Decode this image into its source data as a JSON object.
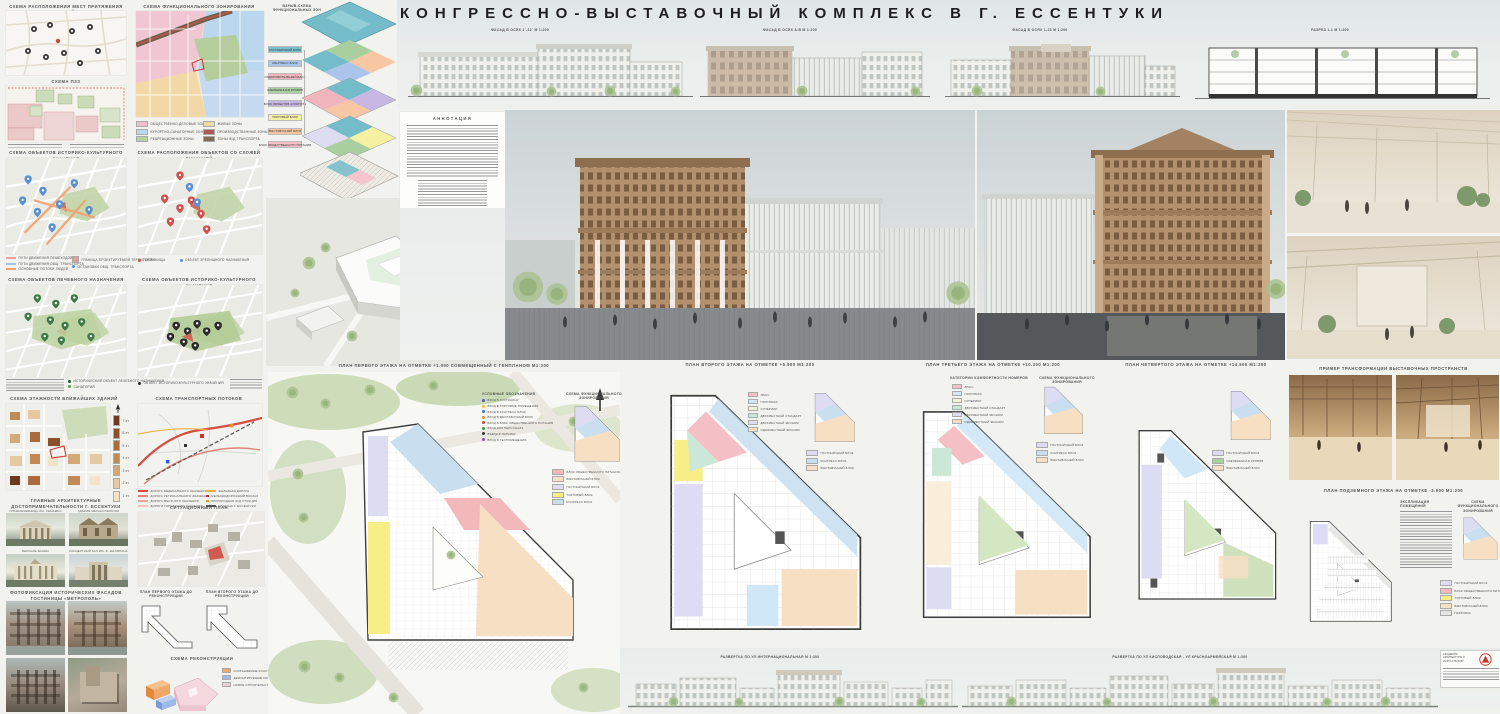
{
  "title": "КОНГРЕССНО-ВЫСТАВОЧНЫЙ КОМПЛЕКС В Г. ЕССЕНТУКИ",
  "top": {
    "facade_a": "ФАСАД В ОСЯХ 1`-22`  М 1:200",
    "facade_b": "ФАСАД В ОСЯХ А-В  М 1:200",
    "facade_c": "ФАСАД В ОСЯХ 1-23  М 1:200",
    "section_label": "РАЗРЕЗ 1-1  М 1:200"
  },
  "annotation": {
    "title": "АННОТАЦИЯ"
  },
  "maps": {
    "attraction_title": "СХЕМА РАСПОЛОЖЕНИЯ МЕСТ ПРИТЯЖЕНИЯ ЛЮДЕЙ",
    "pzz_title": "СХЕМА ПЗЗ",
    "func_title": "СХЕМА ФУНКЦИОНАЛЬНОГО ЗОНИРОВАНИЯ",
    "func_legend": [
      {
        "label": "ОБЩЕСТВЕННО-ДЕЛОВЫЕ ЗОНЫ",
        "color": "#efc0cb"
      },
      {
        "label": "КУРОРТНО-САНАТОРНЫЕ ЗОНЫ",
        "color": "#bad7ee"
      },
      {
        "label": "РЕКРЕАЦИОННЫЕ ЗОНЫ",
        "color": "#bccfa2"
      },
      {
        "label": "ЖИЛЫЕ ЗОНЫ",
        "color": "#f2d8a6"
      },
      {
        "label": "ПРОИЗВОДСТВЕННЫЕ ЗОНЫ",
        "color": "#a95b52"
      },
      {
        "label": "ЗОНЫ Ж/Д ТРАНСПОРТА",
        "color": "#7d6c57"
      }
    ],
    "history1_title": "СХЕМА ОБЪЕКТОВ ИСТОРИКО-КУЛЬТУРНОГО ЗНАЧЕНИЯ",
    "history1_legend": [
      "ПУТИ ДВИЖЕНИЯ ПЕШЕХОДОВ",
      "ПУТИ ДВИЖЕНИЯ ОБЩ. ТРАНСПОРТА",
      "ОСНОВНЫЕ ПОТОКИ ЛЮДЕЙ",
      "ГРАНИЦА ПРОЕКТИРУЕМОЙ ТЕРРИТОРИИ",
      "ОСТАНОВКИ ОБЩ. ТРАНСПОРТА"
    ],
    "similar_title": "СХЕМА РАСПОЛОЖЕНИЯ ОБЪЕКТОВ СО СХОЖЕЙ ФУНКЦИЕЙ",
    "similar_legend": [
      "ГОСТИНИЦЫ",
      "ОБЪЕКТ ЗРЕЛИЩНОГО НАЗНАЧЕНИЯ"
    ],
    "medical_title": "СХЕМА ОБЪЕКТОВ ЛЕЧЕБНОГО НАЗНАЧЕНИЯ",
    "medical_legend": [
      "ИСТОРИЧЕСКИЙ ОБЪЕКТ ЛЕЧЕБНОГО НАЗНАЧЕНИЯ",
      "САНАТОРИЙ"
    ],
    "history2_title": "СХЕМА ОБЪЕКТОВ ИСТОРИКО-КУЛЬТУРНОГО ЗНАЧЕНИЯ",
    "history2_legend": [
      "ОБЪЕКТ ИСТОРИКО-КУЛЬТУРНОГО ЗНАЧЕНИЯ"
    ],
    "floors_title": "СХЕМА ЭТАЖНОСТИ БЛИЖАЙШИХ ЗДАНИЙ",
    "floors_legend": [
      "7 эт.",
      "6 эт.",
      "5 эт.",
      "4 эт.",
      "3 эт.",
      "2 эт.",
      "1 эт."
    ],
    "floors_colors": [
      "#6b3a20",
      "#8a4f2b",
      "#a96a3d",
      "#c08a58",
      "#d4a97a",
      "#e6c9a2",
      "#f3e3c8"
    ],
    "transport_title": "СХЕМА ТРАНСПОРТНЫХ ПОТОКОВ",
    "transport_legend_a": [
      "ДОРОГА ФЕДЕРАЛЬНОГО ЗНАЧЕНИЯ",
      "ДОРОГА РЕГИОНАЛЬНОГО ЗНАЧЕНИЯ",
      "ДОРОГА МЕСТНОГО ЗНАЧЕНИЯ",
      "ДОРОГИ ГОРОДСКОГО ЗНАЧЕНИЯ"
    ],
    "transport_legend_b": [
      "ЖЕЛЕЗНАЯ ДОРОГА",
      "ЖЕЛЕЗНОДОРОЖНЫЙ ВОКЗАЛ",
      "ПРИГОРОДНАЯ Ж/Д СТАНЦИЯ",
      "ГРАНИЦА Г. ЕССЕНТУКИ"
    ],
    "situation_title": "СИТУАЦИОННЫЙ ПЛАН"
  },
  "landmarks": {
    "title": "ГЛАВНЫЕ АРХИТЕКТУРНЫЕ ДОСТОПРИМЕЧАТЕЛЬНОСТИ Г. ЕССЕНТУКИ",
    "captions": [
      "ГРЯЗЕЛЕЧЕБНИЦА ИМ. СЕМАШКО",
      "ЗДАНИЕ МЕХАНОТЕРАПИИ",
      "ВЕРХНИЕ ВАННЫ",
      "КОНЦЕРТНЫЙ ЗАЛ ИМ. Ф. ШАЛЯПИНА"
    ]
  },
  "metropol": {
    "title": "ФОТОФИКСАЦИЯ ИСТОРИЧЕСКИХ ФАСАДОВ ГОСТИНИЦЫ «МЕТРОПОЛЬ»",
    "plan1_title": "ПЛАН ПЕРВОГО ЭТАЖА ДО РЕКОНСТРУКЦИИ",
    "plan2_title": "ПЛАН ВТОРОГО ЭТАЖА ДО РЕКОНСТРУКЦИИ",
    "recon_title": "СХЕМА РЕКОНСТРУКЦИИ",
    "recon_legend": [
      {
        "label": "СОХРАНЯЕМЫЕ КОНСТРУКЦИИ",
        "color": "#f0a868"
      },
      {
        "label": "ДЕМОНТИРУЕМЫЕ КОНСТРУКЦИИ",
        "color": "#9cb9e8"
      },
      {
        "label": "НОВОЕ СТРОИТЕЛЬСТВО",
        "color": "#f2cdd6"
      }
    ]
  },
  "exploded": {
    "title": "ВЗРЫВ-СХЕМА ФУНКЦИОНАЛЬНЫХ ЗОН",
    "legend": [
      {
        "label": "ГОСТИНИЧНЫЙ БЛОК",
        "color": "#79c0cc"
      },
      {
        "label": "КОНГРЕСС БЛОК",
        "color": "#aac4ea"
      },
      {
        "label": "ОЗДОРОВИТЕЛЬНЫЙ БЛОК",
        "color": "#f0b5bd"
      },
      {
        "label": "ОЗЕЛЕНЕННАЯ КРОВЛЯ",
        "color": "#a9cf9f"
      },
      {
        "label": "БЛОК ОБЪЕКТОВ КУЛЬТУРЫ",
        "color": "#c9b7e3"
      },
      {
        "label": "ТОРГОВЫЙ БЛОК",
        "color": "#f5f0a2"
      },
      {
        "label": "ВЫСТАВОЧНЫЙ БЛОК",
        "color": "#f6c7a2"
      },
      {
        "label": "БЛОК ОБЩЕСТВЕННОГО ПИТАНИЯ",
        "color": "#f6c0c8"
      }
    ]
  },
  "plans": {
    "plan1_title": "ПЛАН ПЕРВОГО ЭТАЖА НА ОТМЕТКЕ +1.000 СОВМЕЩЕННЫЙ С ГЕНПЛАНОМ  М1:200",
    "plan1_legend_title": "УСЛОВНЫЕ ОБОЗНАЧЕНИЯ",
    "plan1_entries": [
      "ВХОД В ГОСТИНИЦУ",
      "ВХОД В ТОРГОВЫЕ ПОМЕЩЕНИЯ",
      "ВХОД В КОНГРЕСС БЛОК",
      "ВХОД В ВЫСТАВОЧНЫЙ БЛОК",
      "ВХОД В БЛОК ОБЩЕСТВЕННОГО ПИТАНИЯ",
      "ВХОД ДЛЯ ПЕРСОНАЛА",
      "ВЪЕЗД В ПАРКИНГ",
      "ВХОД В ТЕХПОМЕЩЕНИЯ"
    ],
    "plan1_entry_colors": [
      "#5a55c8",
      "#e8c832",
      "#3a78c8",
      "#e08a3a",
      "#c84848",
      "#3a9a50",
      "#333333",
      "#8a4fa8"
    ],
    "plan2_title": "ПЛАН ВТОРОГО ЭТАЖА НА ОТМЕТКЕ +5.900  М1:200",
    "plan3_title": "ПЛАН ТРЕТЬЕГО ЭТАЖА НА ОТМЕТКЕ +10.200  М1:200",
    "plan4_title": "ПЛАН ЧЕТВЕРТОГО ЭТАЖА НА ОТМЕТКЕ +14.500  М1:200",
    "under_title": "ПЛАН ПОДЗЕМНОГО ЭТАЖА НА ОТМЕТКЕ  -3.900  М1:200",
    "under_expl_title": "ЭКСПЛИКАЦИЯ ПОМЕЩЕНИЙ",
    "zone_scheme_title": "СХЕМА ФУНКЦИОНАЛЬНОГО ЗОНИРОВАНИЯ",
    "rooms_title": "КАТЕГОРИИ КОМФОРТНОСТИ НОМЕРОВ",
    "rooms_legend": [
      {
        "label": "ЛЮКС",
        "color": "#f5c0c5"
      },
      {
        "label": "ПОЛУЛЮКС",
        "color": "#cfe7f6"
      },
      {
        "label": "СУПЕРИОР",
        "color": "#f8eeda"
      },
      {
        "label": "ДВУХМЕСТНЫЙ СТАНДАРТ",
        "color": "#cbe7d8"
      },
      {
        "label": "ДВУХМЕСТНЫЙ ЭКОНОМ",
        "color": "#dedcf2"
      },
      {
        "label": "ОДНОМЕСТНЫЙ ЭКОНОМ",
        "color": "#f7dfc3"
      }
    ],
    "zones": [
      {
        "label": "ГОСТИНИЧНЫЙ БЛОК",
        "color": "#dedcf2"
      },
      {
        "label": "КОНГРЕСС БЛОК",
        "color": "#c9dff0"
      },
      {
        "label": "ВЫСТАВОЧНЫЙ БЛОК",
        "color": "#f7dfc3"
      },
      {
        "label": "ТОРГОВЫЙ БЛОК",
        "color": "#f7ef86"
      },
      {
        "label": "БЛОК ОБЩЕСТВЕННОГО ПИТАНИЯ",
        "color": "#f3b9ba"
      },
      {
        "label": "ПАРКОВКА",
        "color": "#e4e4e2"
      }
    ]
  },
  "transform": {
    "title": "ПРИМЕР ТРАНСФОРМАЦИИ ВЫСТАВОЧНЫХ ПРОСТРАНСТВ"
  },
  "elevations": {
    "street1": "РАЗВЕРТКА ПО УЛ ИНТЕРНАЦИОНАЛЬНАЯ М 1:300",
    "street2": "РАЗВЕРТКА ПО УЛ КИСЛОВОДСКАЯ - УЛ КРАСНОАРМЕЙСКАЯ  М 1:300"
  },
  "stamp": {
    "org": "АКАДЕМИЯ АРХИТЕКТУРЫ И ИСКУССТВ ЮФУ"
  }
}
